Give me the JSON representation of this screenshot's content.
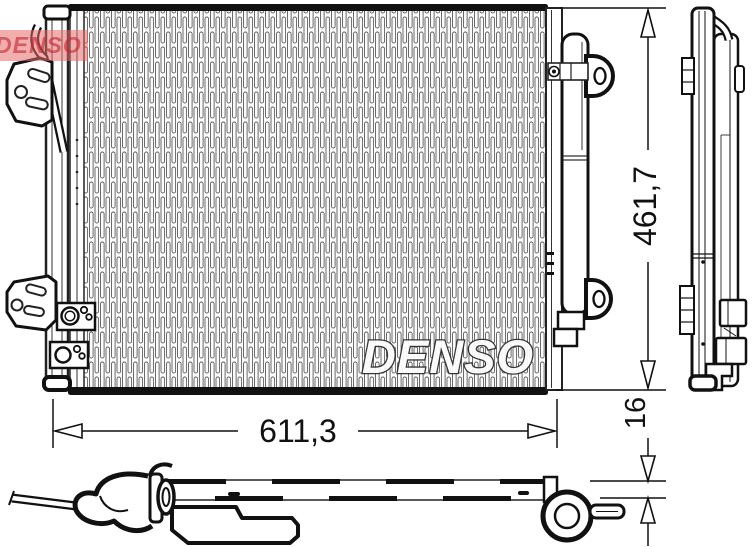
{
  "logo": {
    "brand": "DENSO"
  },
  "watermark": {
    "brand": "DENSO"
  },
  "dimensions": {
    "width": "611,3",
    "height": "461,7",
    "thickness": "16"
  },
  "colors": {
    "line": "#111111",
    "fin_line": "#5a5a5a",
    "watermark_fill": "#ffffff",
    "watermark_outline": "#2a2a2a",
    "logo_red": "#e76a6a",
    "background": "#ffffff"
  }
}
